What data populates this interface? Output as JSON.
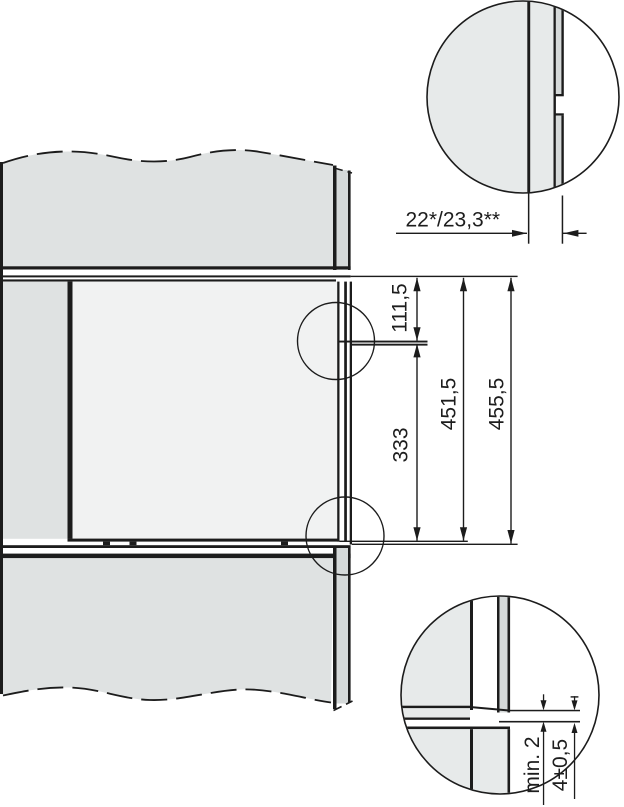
{
  "drawing": {
    "type": "appliance-installation-section-diagram",
    "dimensions": {
      "front_panel_thickness": "22*/23,3**",
      "rail_offset_top": "111,5",
      "rail_offset_bottom": "333",
      "appliance_height": "451,5",
      "niche_height": "455,5",
      "min_gap": "min. 2",
      "bottom_clearance": "4±0,5"
    },
    "colors": {
      "line": "#1c1c1c",
      "panel_fill": "#dfe2e2",
      "panel_fill_light": "#e7eaea",
      "edge_strip_fill": "#d5d9d9",
      "appliance_fill": "#f1f2f2",
      "background": "#ffffff"
    }
  }
}
